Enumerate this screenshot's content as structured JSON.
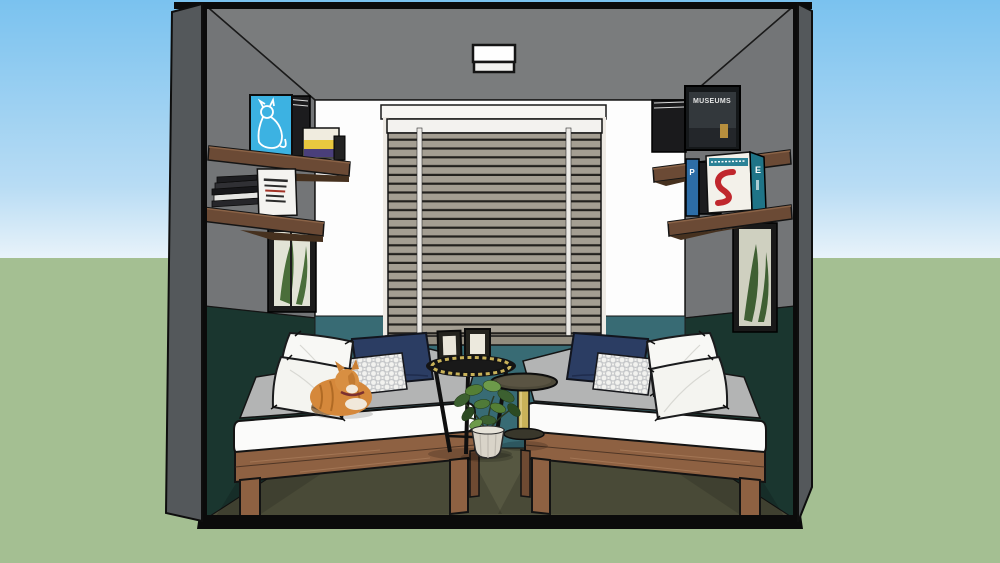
{
  "texts": {
    "museums_book_title": "MUSEUMS",
    "chair_book_spine_letter": "E",
    "blue_book_spine_letter": "P"
  },
  "palette": {
    "sky_top": "#7ac2ef",
    "sky_mid": "#b8dcf4",
    "sky_horizon": "#e9f3fa",
    "ground": "#a4bf92",
    "outer_wall": "#54585b",
    "ceiling": "#7a7c7d",
    "wall": "#737577",
    "back_wall": "#fdfdfd",
    "wainscot": "#386b74",
    "wall_lower": "#1a362f",
    "floor": "#565741",
    "blind_slat": "#a49e92",
    "blind_header": "#f3f2ef",
    "shelf_wood": "#6b4a35",
    "bed_wood": "#8e6142",
    "blanket": "#b3b4b4",
    "mattress": "#fbfbfa",
    "navy": "#2b3d63",
    "pillow_white": "#f8f8f5",
    "gold": "#c9b259",
    "pot": "#d9d4c9",
    "plant_green": "#4f7a38",
    "poster_blue": "#3cb2e2",
    "chair_red": "#c0272d",
    "spine_teal": "#1f7487",
    "cat_orange": "#d5883b"
  }
}
